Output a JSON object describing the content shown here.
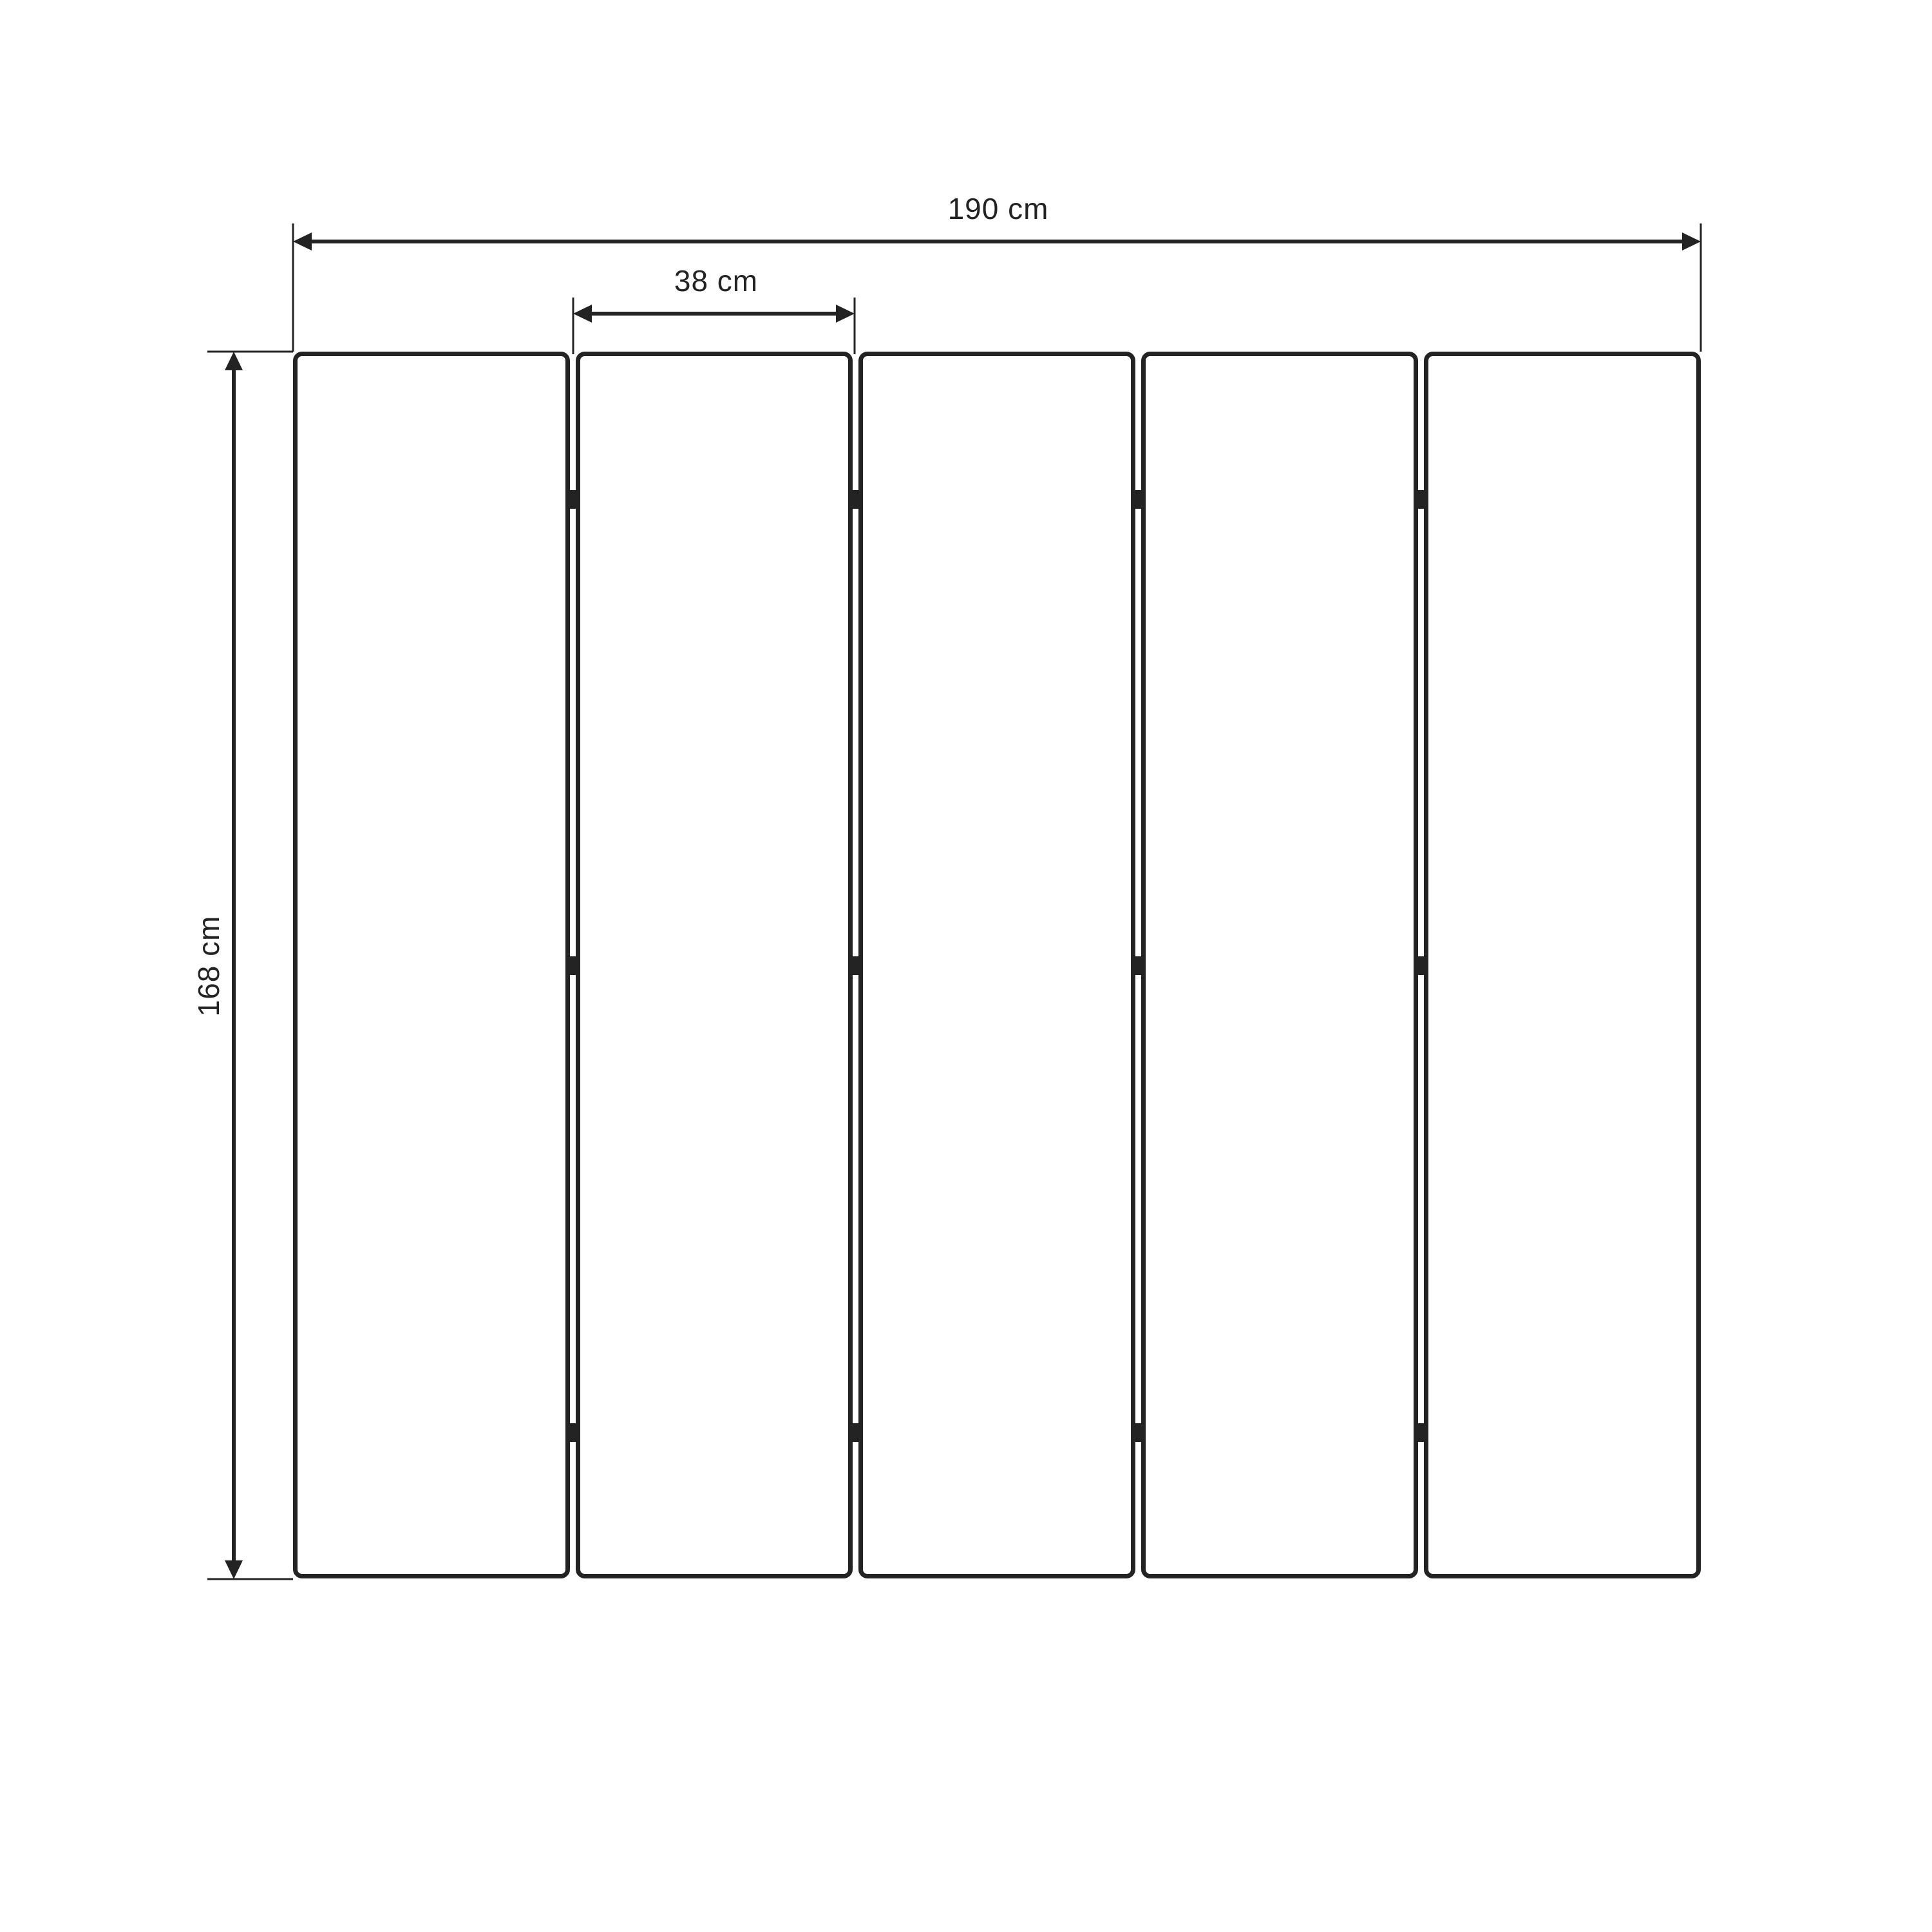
{
  "diagram": {
    "type": "technical-drawing",
    "subject": "five-panel folding screen, front elevation",
    "panel_count": 5,
    "hinge_rows": 3,
    "dimensions": {
      "overall_width": {
        "label": "190 cm",
        "value": 190,
        "unit": "cm"
      },
      "single_panel_width": {
        "label": "38 cm",
        "value": 38,
        "unit": "cm"
      },
      "overall_height": {
        "label": "168 cm",
        "value": 168,
        "unit": "cm"
      }
    },
    "line_color": "#232323",
    "background_color": "#ffffff"
  }
}
